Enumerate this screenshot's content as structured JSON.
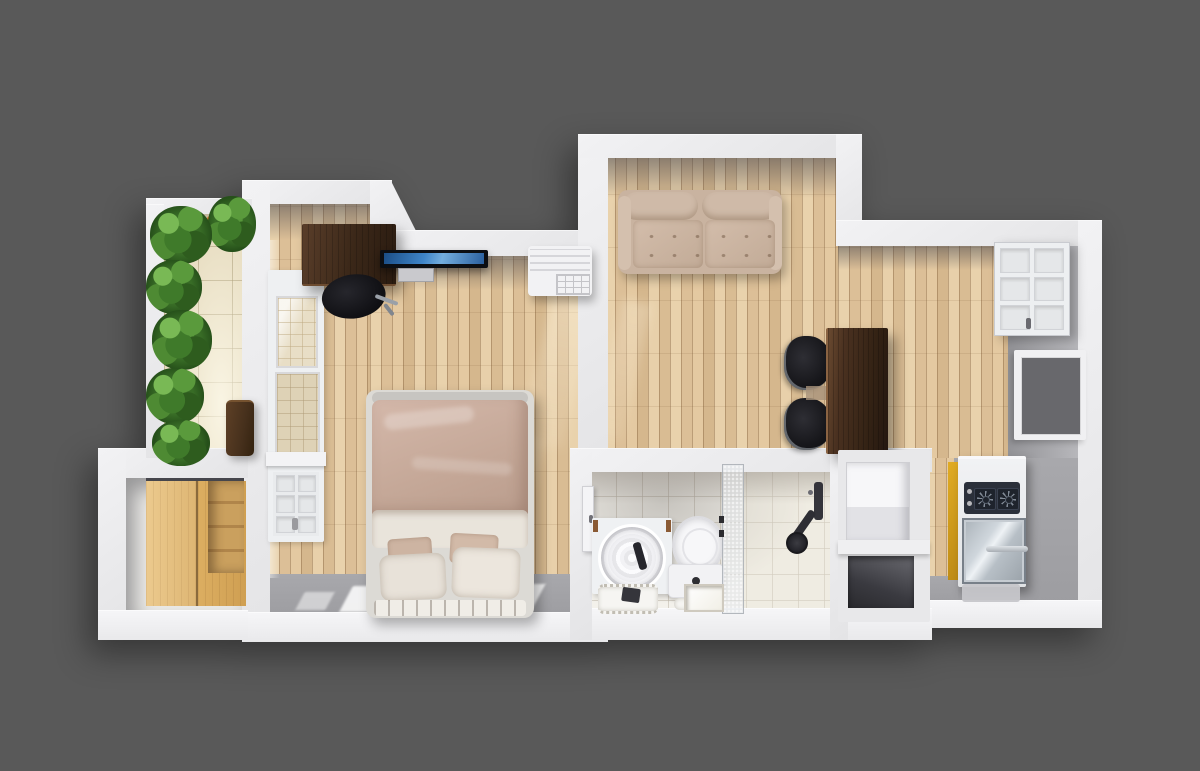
{
  "scene": {
    "type": "3d-floorplan-top-view",
    "description": "Top-down 3D rendering of a small studio apartment floor plan centered on a dark gray backdrop",
    "background_color": "#595959",
    "text_visible": false
  },
  "palette": {
    "background": "#595959",
    "wall_white": "#ececee",
    "wall_inner_shadow": "#6a6a72",
    "wood_plank_floor": "#ddc19b",
    "balcony_tile": "#e9dfc4",
    "bathroom_tile": "#f3f1eb",
    "gray_concrete_floor": "#a4a4a8",
    "duvet_rose": "#c8ab9c",
    "sheet_white": "#e9e4db",
    "sofa_beige": "#c9b3a0",
    "dark_walnut": "#3a2718",
    "maple_wardrobe": "#e0ba77",
    "kitchen_yellow": "#d29a1c",
    "cooktop_charcoal": "#2b303a",
    "tv_screen_blue": "#3f85c8",
    "plant_green": "#4c8a33"
  },
  "rooms": [
    {
      "name": "balcony",
      "label": "Balcony with plants",
      "floor": "beige-tile",
      "furniture": [
        "potted-plants",
        "flower-planter",
        "wood-stool"
      ]
    },
    {
      "name": "storage-room",
      "label": "Storage room",
      "floor": "light-gray",
      "furniture": [
        "maple-sliding-wardrobe",
        "step-shelves"
      ]
    },
    {
      "name": "bedroom",
      "label": "Bedroom",
      "floor": "wood-plank",
      "furniture": [
        "desk",
        "office-chair",
        "wall-tv",
        "air-conditioner",
        "double-bed",
        "paneled-window"
      ]
    },
    {
      "name": "living-room",
      "label": "Living room",
      "floor": "wood-plank",
      "furniture": [
        "loveseat-sofa",
        "dining-table",
        "dining-chairs",
        "closet-door",
        "side-window"
      ]
    },
    {
      "name": "bathroom",
      "label": "Bathroom",
      "floor": "white-tile",
      "furniture": [
        "bathroom-door",
        "round-basin-vanity",
        "basin-mat",
        "toilet",
        "toilet-mat",
        "glass-partition",
        "shower-set",
        "floor-drain"
      ]
    },
    {
      "name": "kitchen-nook",
      "label": "Kitchen nook",
      "floor": "gray-concrete",
      "furniture": [
        "washing-machine",
        "open-cavity",
        "kitchenette-stove-fridge",
        "floor-mat"
      ]
    }
  ]
}
